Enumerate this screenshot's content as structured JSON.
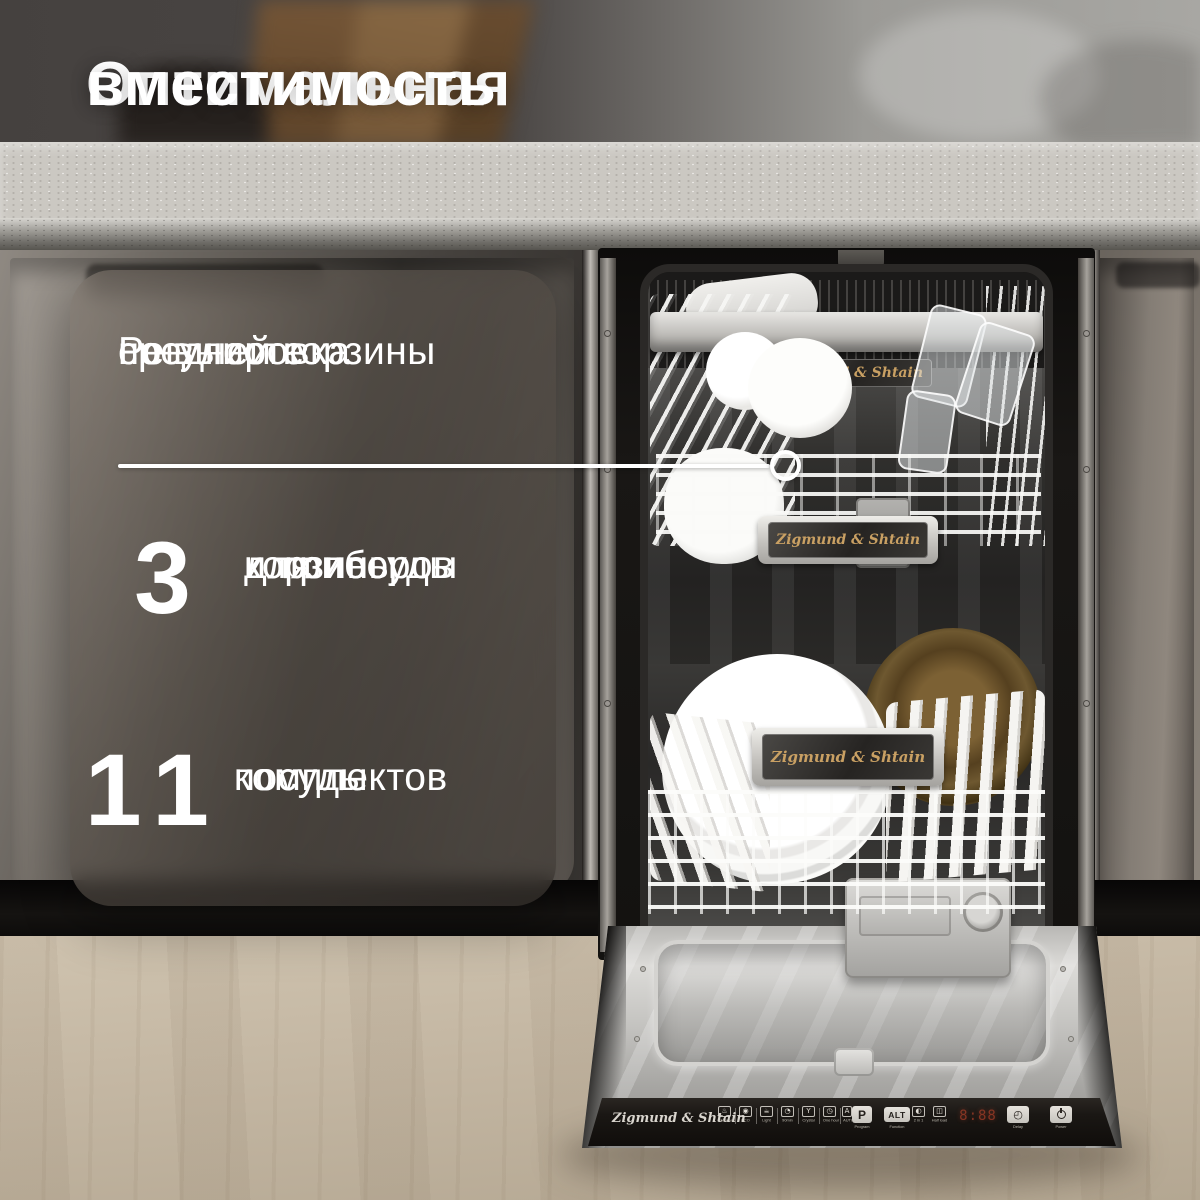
{
  "title": {
    "line1": "Оптимальная",
    "line2": "вместимость"
  },
  "card": {
    "heading": {
      "line1": "Регулировка",
      "line2": "средней корзины",
      "line3": "по высоте"
    },
    "stats": [
      {
        "value": "3",
        "label_lines": [
          "корзины",
          "для посуды",
          "и приборов"
        ]
      },
      {
        "value": "11",
        "label_lines": [
          "комплектов",
          "посуды"
        ]
      }
    ]
  },
  "brand": {
    "name": "Zigmund & Shtain"
  },
  "dishwasher": {
    "plaques": [
      {
        "location": "upper-rail",
        "text": "Zigmund & Shtain"
      },
      {
        "location": "middle-basket",
        "text": "Zigmund & Shtain"
      },
      {
        "location": "lower-basket",
        "text": "Zigmund & Shtain"
      }
    ],
    "control_panel": {
      "logo": "Zigmund & Shtain",
      "program_keys": [
        {
          "icon": "intensive-program-icon",
          "glyph": "♨",
          "label": "Intensive"
        },
        {
          "icon": "eco-program-icon",
          "glyph": "◉",
          "label": "ECO"
        },
        {
          "icon": "light-program-icon",
          "glyph": "☕",
          "label": "Light"
        },
        {
          "icon": "90min-program-icon",
          "glyph": "◔",
          "label": "90min"
        },
        {
          "icon": "crystal-program-icon",
          "glyph": "Y",
          "label": "Crystal"
        },
        {
          "icon": "one-hour-program-icon",
          "glyph": "◷",
          "label": "One hour"
        },
        {
          "icon": "auto-program-icon",
          "glyph": "A",
          "label": "AUTO"
        }
      ],
      "p_key": {
        "symbol": "P",
        "label": "Program"
      },
      "alt_key": {
        "symbol": "ALT",
        "label": "Function"
      },
      "two_in_one_key": {
        "glyph": "◐",
        "label": "2 in 1"
      },
      "half_load_key": {
        "glyph": "◫",
        "label": "Half load"
      },
      "display": {
        "value": "8:88"
      },
      "delay_key": {
        "glyph": "◴",
        "label": "Delay"
      },
      "power_key": {
        "label": "Power"
      }
    }
  },
  "colors": {
    "text": "#ffffff",
    "card_bg": "rgba(86,79,72,0.62)",
    "panel_bg": "#1a1714",
    "display_red": "#cd482d",
    "plaque_gold": "#c9a063",
    "floor_wood": "#c3b6a2",
    "countertop": "#cbc8c2"
  }
}
